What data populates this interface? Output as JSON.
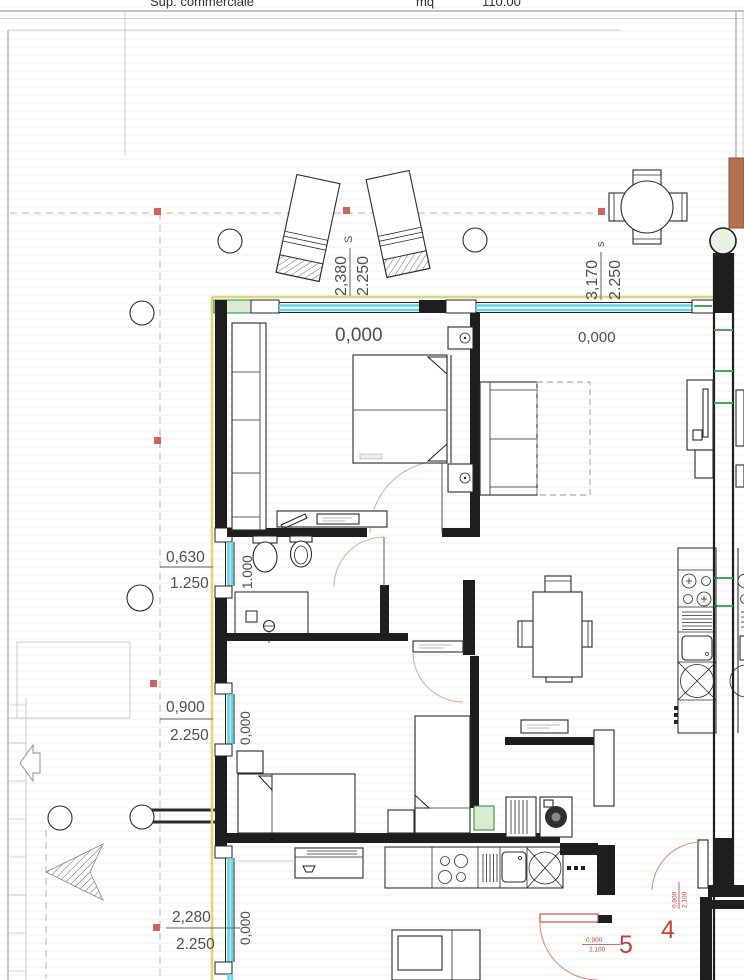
{
  "header": {
    "title_fragment": "Sup. commerciale",
    "unit_label": "mq",
    "area_value": "110.00"
  },
  "dims": {
    "lounger": {
      "letter": "S",
      "num": "2,380",
      "den": "2.250"
    },
    "table": {
      "letter": "s",
      "num": "3,170",
      "den": "2.250"
    },
    "bath_window": {
      "num": "0,630",
      "den": "1.250"
    },
    "bath_sill": "1.000",
    "bed2_window": {
      "num": "0,900",
      "den": "2.250"
    },
    "kitchen_window": {
      "num": "2,280",
      "den": "2.250"
    }
  },
  "levels": {
    "bedroom_window": "0,000",
    "living_window": "0,000",
    "bed2_window": "0,000",
    "kitchen_window": "0,000"
  },
  "doors": {
    "d4": {
      "number": "4",
      "num": "0,900",
      "den": "2.100"
    },
    "d5": {
      "number": "5",
      "num": "0,900",
      "den": "2.100"
    }
  },
  "colors": {
    "window_glass": "#5fd3e8",
    "unit_boundary": "#ddd47e",
    "wall": "#1e1e1e",
    "green_accent": "#46a45d",
    "green_fill": "#d9ecd2",
    "red_marker": "#d2625a",
    "door_label_red": "#c2413b",
    "door_arc": "#d98c85",
    "masonry_sienna": "#b5714f"
  }
}
